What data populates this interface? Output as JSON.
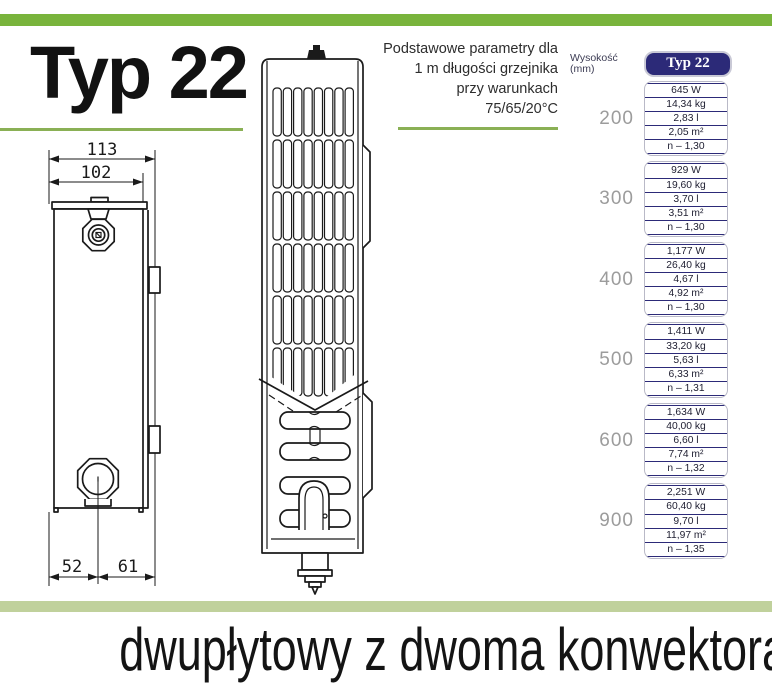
{
  "page": {
    "heading": "Typ 22",
    "subtitle_lines": {
      "0": "Podstawowe parametry dla",
      "1": "1 m długości grzejnika",
      "2": "przy warunkach",
      "3": "75/65/20°C"
    },
    "bottom_caption": "dwupłytowy z dwoma konwektorami"
  },
  "drawing": {
    "dim_top_outer": "113",
    "dim_top_inner": "102",
    "dim_bottom_left": "52",
    "dim_bottom_right": "61"
  },
  "table": {
    "col_header_left": "Wysokość (mm)",
    "col_header_right": "Typ 22",
    "groups": [
      {
        "height": "200",
        "values": [
          "645 W",
          "14,34 kg",
          "2,83 l",
          "2,05 m²",
          "n – 1,30"
        ]
      },
      {
        "height": "300",
        "values": [
          "929 W",
          "19,60 kg",
          "3,70 l",
          "3,51 m²",
          "n – 1,30"
        ]
      },
      {
        "height": "400",
        "values": [
          "1,177 W",
          "26,40 kg",
          "4,67 l",
          "4,92 m²",
          "n – 1,30"
        ]
      },
      {
        "height": "500",
        "values": [
          "1,411 W",
          "33,20 kg",
          "5,63 l",
          "6,33 m²",
          "n – 1,31"
        ]
      },
      {
        "height": "600",
        "values": [
          "1,634 W",
          "40,00 kg",
          "6,60 l",
          "7,74 m²",
          "n – 1,32"
        ]
      },
      {
        "height": "900",
        "values": [
          "2,251 W",
          "60,40 kg",
          "9,70 l",
          "11,97 m²",
          "n – 1,35"
        ]
      }
    ]
  },
  "colors": {
    "accent_green": "#79b43c",
    "line_green": "#8ab055",
    "pale_green": "#c0d19c",
    "navy": "#2c2a78",
    "grey_label": "#9c9c9c"
  }
}
